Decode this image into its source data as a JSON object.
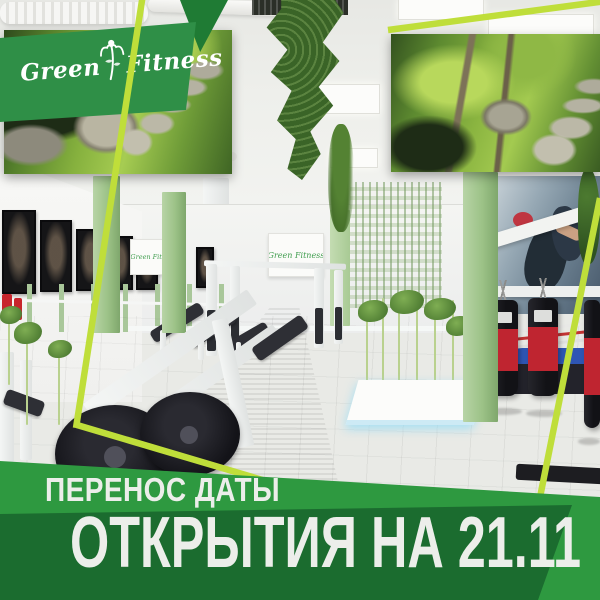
{
  "brand": {
    "name_first": "Green",
    "name_second": "Fitness",
    "full_name": "Green Fitness",
    "panel_green": "#2F8F47",
    "lime_accent": "#BFDE3A"
  },
  "headline": {
    "line1": "ПЕРЕНОС ДАТЫ",
    "line2": "ОТКРЫТИЯ НА 21.11",
    "band_green": "#2E9940",
    "band_dark_green": "#1B6C2F",
    "text_color": "#ECEEEA"
  },
  "wall_signs": [
    {
      "text": "Green Fitness"
    },
    {
      "text": "Green Fitness"
    }
  ],
  "scene_colors": {
    "carpet_green": "#3DA226",
    "column_sage": "#9CC287",
    "ceiling": "#EEEFEB",
    "floor": "#D8D8D4"
  }
}
